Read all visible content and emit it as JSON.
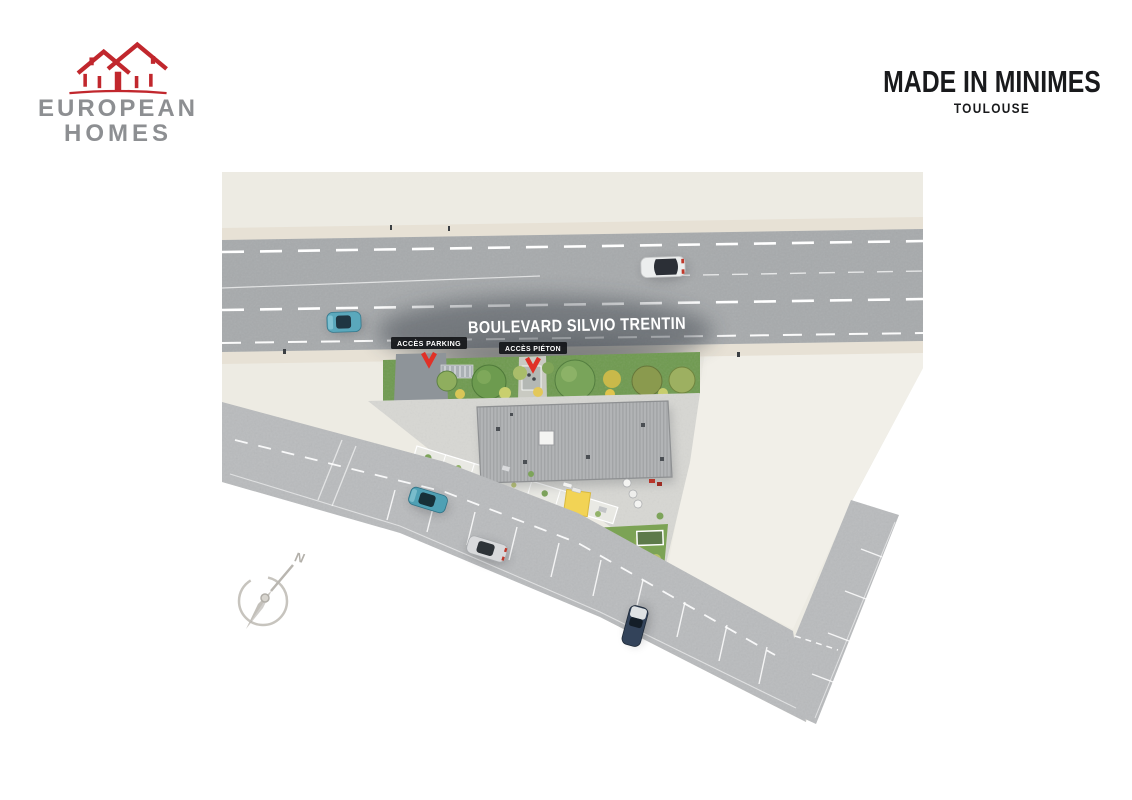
{
  "header": {
    "logo": {
      "line1": "EUROPEAN",
      "line2": "HOMES"
    },
    "title": "MADE IN MINIMES",
    "subtitle": "TOULOUSE"
  },
  "plan": {
    "street_name": "BOULEVARD SILVIO TRENTIN",
    "labels": {
      "access_parking": "ACCÈS PARKING",
      "access_pedestrian": "ACCÈS PIÉTON"
    },
    "compass": {
      "north": "N"
    }
  },
  "colors": {
    "brand_red": "#c1272d",
    "brand_gray": "#8d8f92",
    "title_black": "#191a1c",
    "land_beige": "#edebe3",
    "parcel_beige": "#f1efe8",
    "sidewalk": "#e7e1d5",
    "road_dark_gray": "#a7aaac",
    "road_light_gray": "#bcbebf",
    "roof_gray": "#b2b4b6",
    "plaza_gray": "#d7d7d3",
    "vegetation_green": "#6f9a50",
    "accent_yellow": "#f2d355",
    "label_bg": "#16181b",
    "arrow_red": "#e03127",
    "compass_gray": "#c3c0ba",
    "car_teal": "#4fa0b4",
    "car_silver": "#d9dadc",
    "car_dark": "#33435a"
  }
}
